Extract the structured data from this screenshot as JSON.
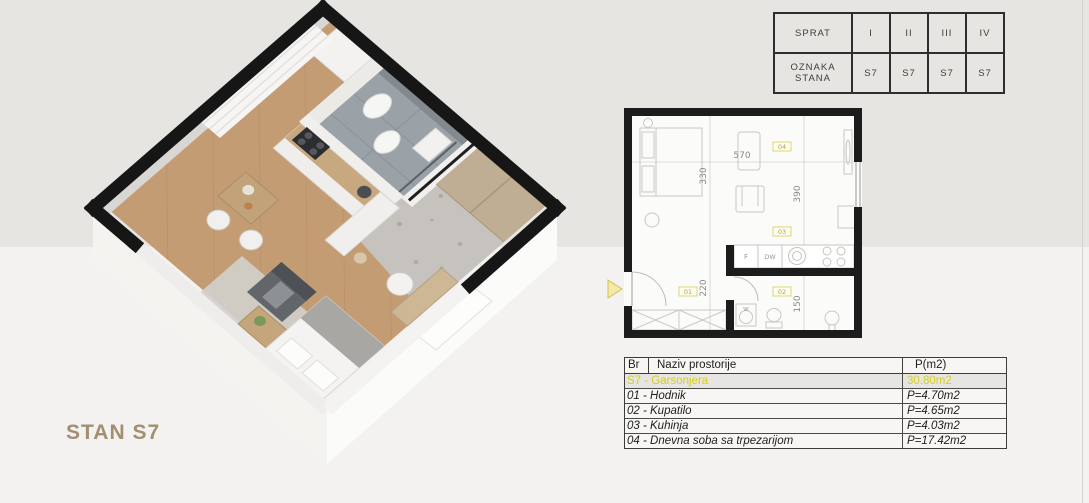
{
  "title": {
    "text": "STAN S7",
    "color": "#a28f72"
  },
  "legend_table": {
    "row1_label": "SPRAT",
    "row2_label": "OZNAKA STANA",
    "floors": [
      "I",
      "II",
      "III",
      "IV"
    ],
    "units": [
      "S7",
      "S7",
      "S7",
      "S7"
    ]
  },
  "rooms_table": {
    "col_br": "Br",
    "col_name": "Naziv prostorije",
    "col_area": "P(m2)",
    "summary_name": "S7 - Garsonjera",
    "summary_area": "30.80m2",
    "rows": [
      {
        "name": "01 - Hodnik",
        "area": "P=4.70m2"
      },
      {
        "name": "02 - Kupatilo",
        "area": "P=4.65m2"
      },
      {
        "name": "03 - Kuhinja",
        "area": "P=4.03m2"
      },
      {
        "name": "04 - Dnevna soba sa trpezarijom",
        "area": "P=17.42m2"
      }
    ]
  },
  "plan": {
    "dim_top": "570",
    "dim_left_upper": "330",
    "dim_right_upper": "390",
    "dim_left_lower": "220",
    "dim_right_lower": "150",
    "label_livingroom": "04",
    "label_kitchen": "03",
    "label_hall": "01",
    "label_bath": "02",
    "fridge": "F",
    "dishwasher": "DW",
    "washer": "W"
  },
  "colors": {
    "accent_yellow": "#d6cd24",
    "label_yellow_border": "#d9cb4e",
    "wall_black": "#1c1c1c",
    "wood_floor": "#c49c74",
    "terrazzo_floor": "#c6c3bf",
    "bath_tile": "#9aa1a7",
    "wardrobe_wood": "#bfae93",
    "title_tan": "#a28f72",
    "background_top": "#e6e5e2",
    "background_bottom": "#f3f2f0"
  }
}
